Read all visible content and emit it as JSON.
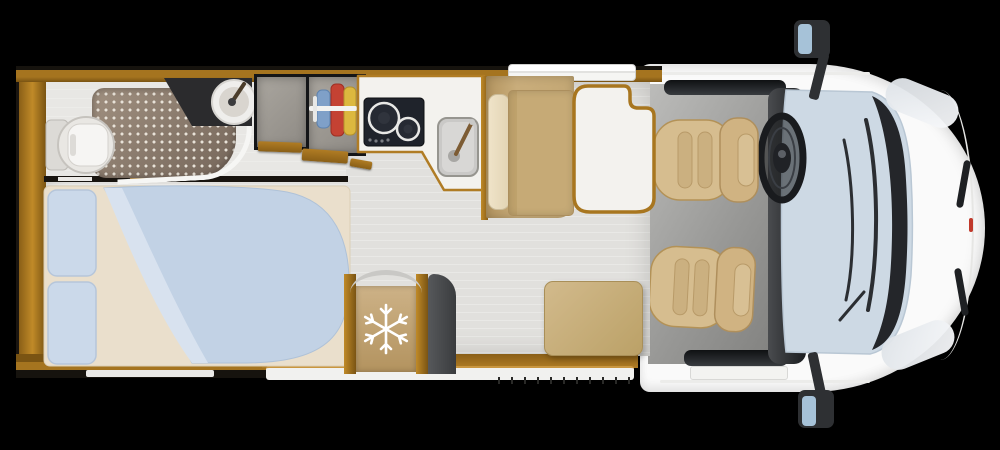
{
  "meta": {
    "title": "Motorhome floor plan - top view",
    "view": "top-down",
    "style": "photorealistic 3D floor plan on black background"
  },
  "colors": {
    "background": "#000000",
    "body-white": "#fafafa",
    "wood": "#a5741f",
    "wood-dark": "#7a5413",
    "floor": "#e1e0dd",
    "cab-floor": "#989896",
    "windshield": "#cdd9e4",
    "mirror-glass": "#a6c2d8",
    "bed-blanket": "#c2d2e5",
    "pillow": "#cbd9ea",
    "mattress": "#eadfcc",
    "seat-tan": "#d6bd8f",
    "bench-tan": "#c9ad7b",
    "cushion-cream": "#e2d4b4",
    "table-top": "#f3f2ee",
    "hob": "#1f232b",
    "vanity": "#2b2b2d",
    "shower-tray": "#75665a",
    "shower-dot": "#e8e2d8",
    "fridge-door": "#b3935f",
    "snowflake": "#ffffff",
    "dark-trim": "#27292b",
    "clothes-blue": "#7fa0c8",
    "clothes-red": "#c44233",
    "clothes-yellow": "#dcb83f",
    "marker-red": "#c0392b"
  },
  "icons": [
    {
      "name": "snowflake-icon",
      "meaning": "refrigerator / freezer"
    },
    {
      "name": "steering-wheel-icon",
      "meaning": "driver position"
    },
    {
      "name": "hangers-icon",
      "meaning": "wardrobe with hanging clothes"
    },
    {
      "name": "hob-burners-icon",
      "meaning": "two-burner gas hob"
    }
  ],
  "areas": {
    "vehicle": "Semi-integrated motorhome - top view floor plan",
    "bathroom": "Bathroom",
    "shower": "Shower tray",
    "toilet": "Toilet",
    "washbasin": "Washbasin vanity",
    "cabinet": "Storage cabinet",
    "wardrobe": "Wardrobe",
    "kitchen": "Kitchen worktop",
    "hob": "Two-burner hob",
    "sink": "Kitchen sink",
    "entrydoor": "Entry door",
    "dinette": "Dinette bench",
    "table": "Dinette table",
    "bed": "Rear double bed",
    "fridge": "Refrigerator",
    "ottoman": "Ottoman cushion",
    "cab": "Driver cab",
    "driverseat": "Swivelled driver seat",
    "passengerseat": "Swivelled passenger seat",
    "steeringwheel": "Steering wheel",
    "windshield": "Windshield",
    "mirrortop": "Left side mirror",
    "mirrorbottom": "Right side mirror"
  }
}
